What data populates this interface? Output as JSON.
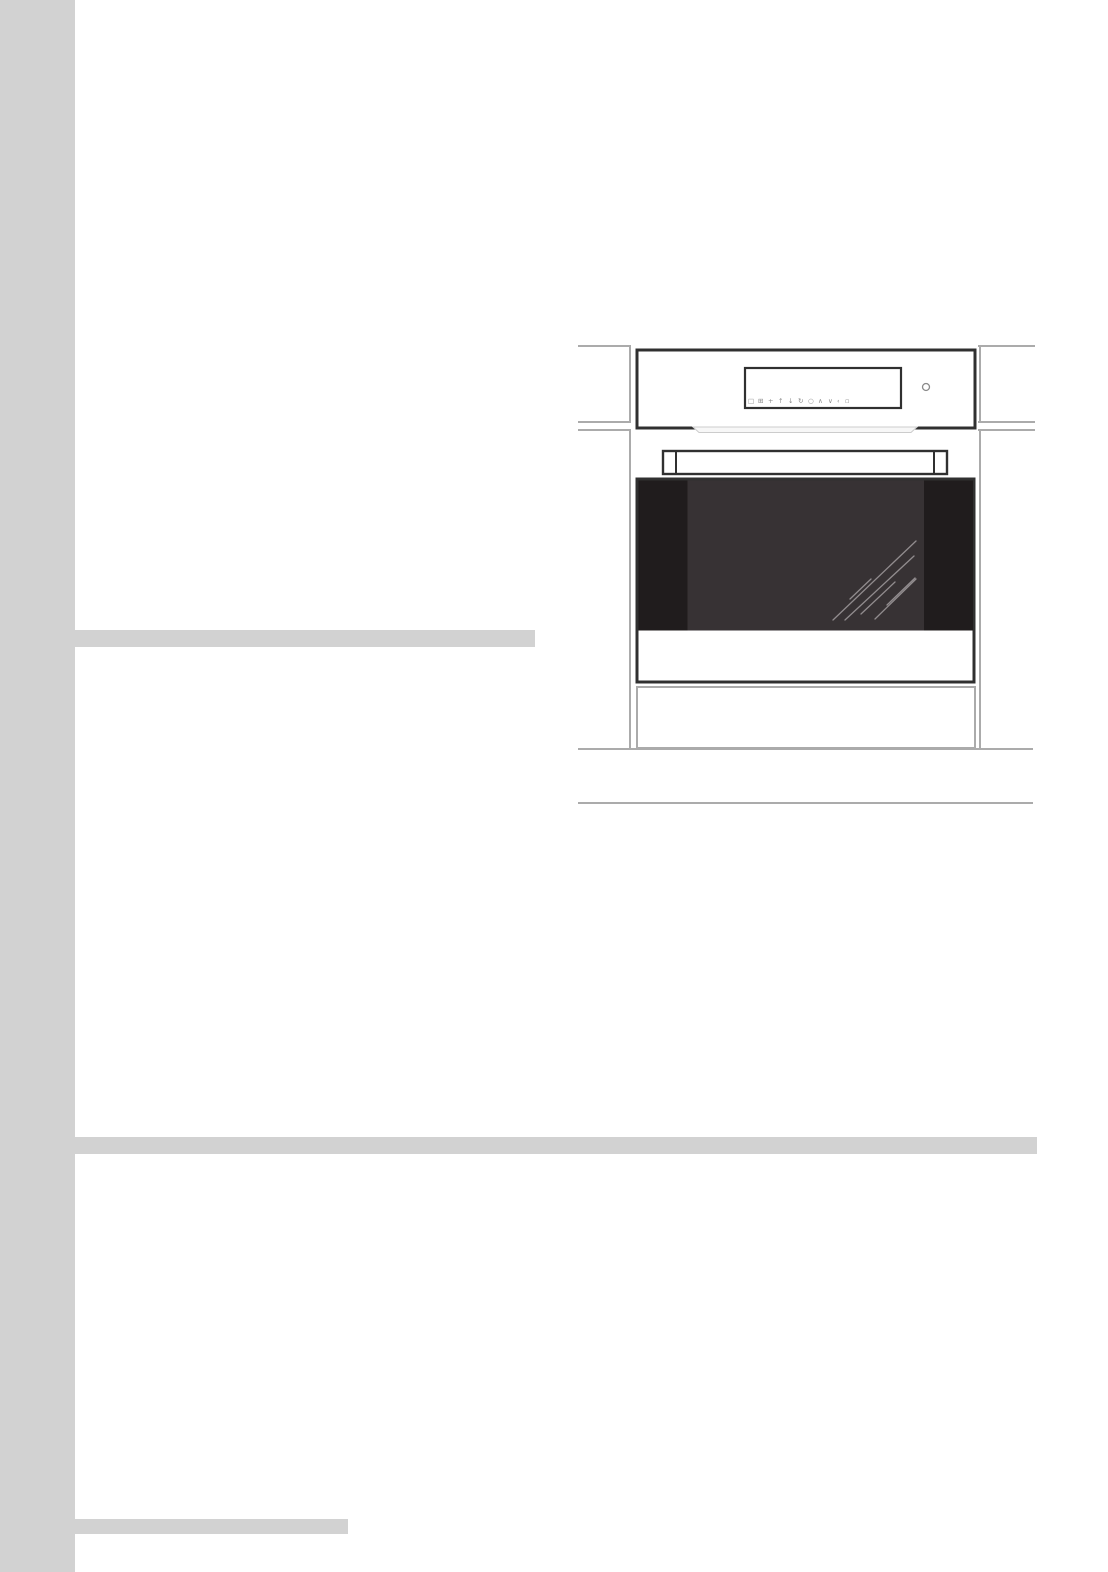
{
  "page": {
    "background": "#ffffff",
    "margin_band_color": "#d2d2d2",
    "divider_color": "#d2d2d2"
  },
  "css_vars": {
    "band": "#d2d2d2",
    "divider": "#d2d2d2"
  },
  "illustration": {
    "label": "built-in-oven-front-view-installation-diagram",
    "colors": {
      "cabinet_line": "#ababab",
      "outline": "#303030",
      "glass_center": "#373234",
      "glass_edge": "#201c1d",
      "reflection": "#918c8e",
      "vent_fill": "#f7f7f7",
      "vent_stroke": "#cccccc",
      "icon_color": "#8a8a8a",
      "white": "#ffffff"
    },
    "control_panel": {
      "icons": [
        {
          "name": "display-icon",
          "glyph": "□"
        },
        {
          "name": "grill-icon",
          "glyph": "⊞"
        },
        {
          "name": "plus-icon",
          "glyph": "+"
        },
        {
          "name": "arrow-up-icon",
          "glyph": "↑"
        },
        {
          "name": "arrow-down-icon",
          "glyph": "↓"
        },
        {
          "name": "rotate-icon",
          "glyph": "↻"
        },
        {
          "name": "timer-icon",
          "glyph": "○"
        },
        {
          "name": "chevron-up-icon",
          "glyph": "∧"
        },
        {
          "name": "chevron-down-icon",
          "glyph": "∨"
        },
        {
          "name": "back-icon",
          "glyph": "‹"
        },
        {
          "name": "stop-icon",
          "glyph": "▫"
        }
      ]
    }
  }
}
